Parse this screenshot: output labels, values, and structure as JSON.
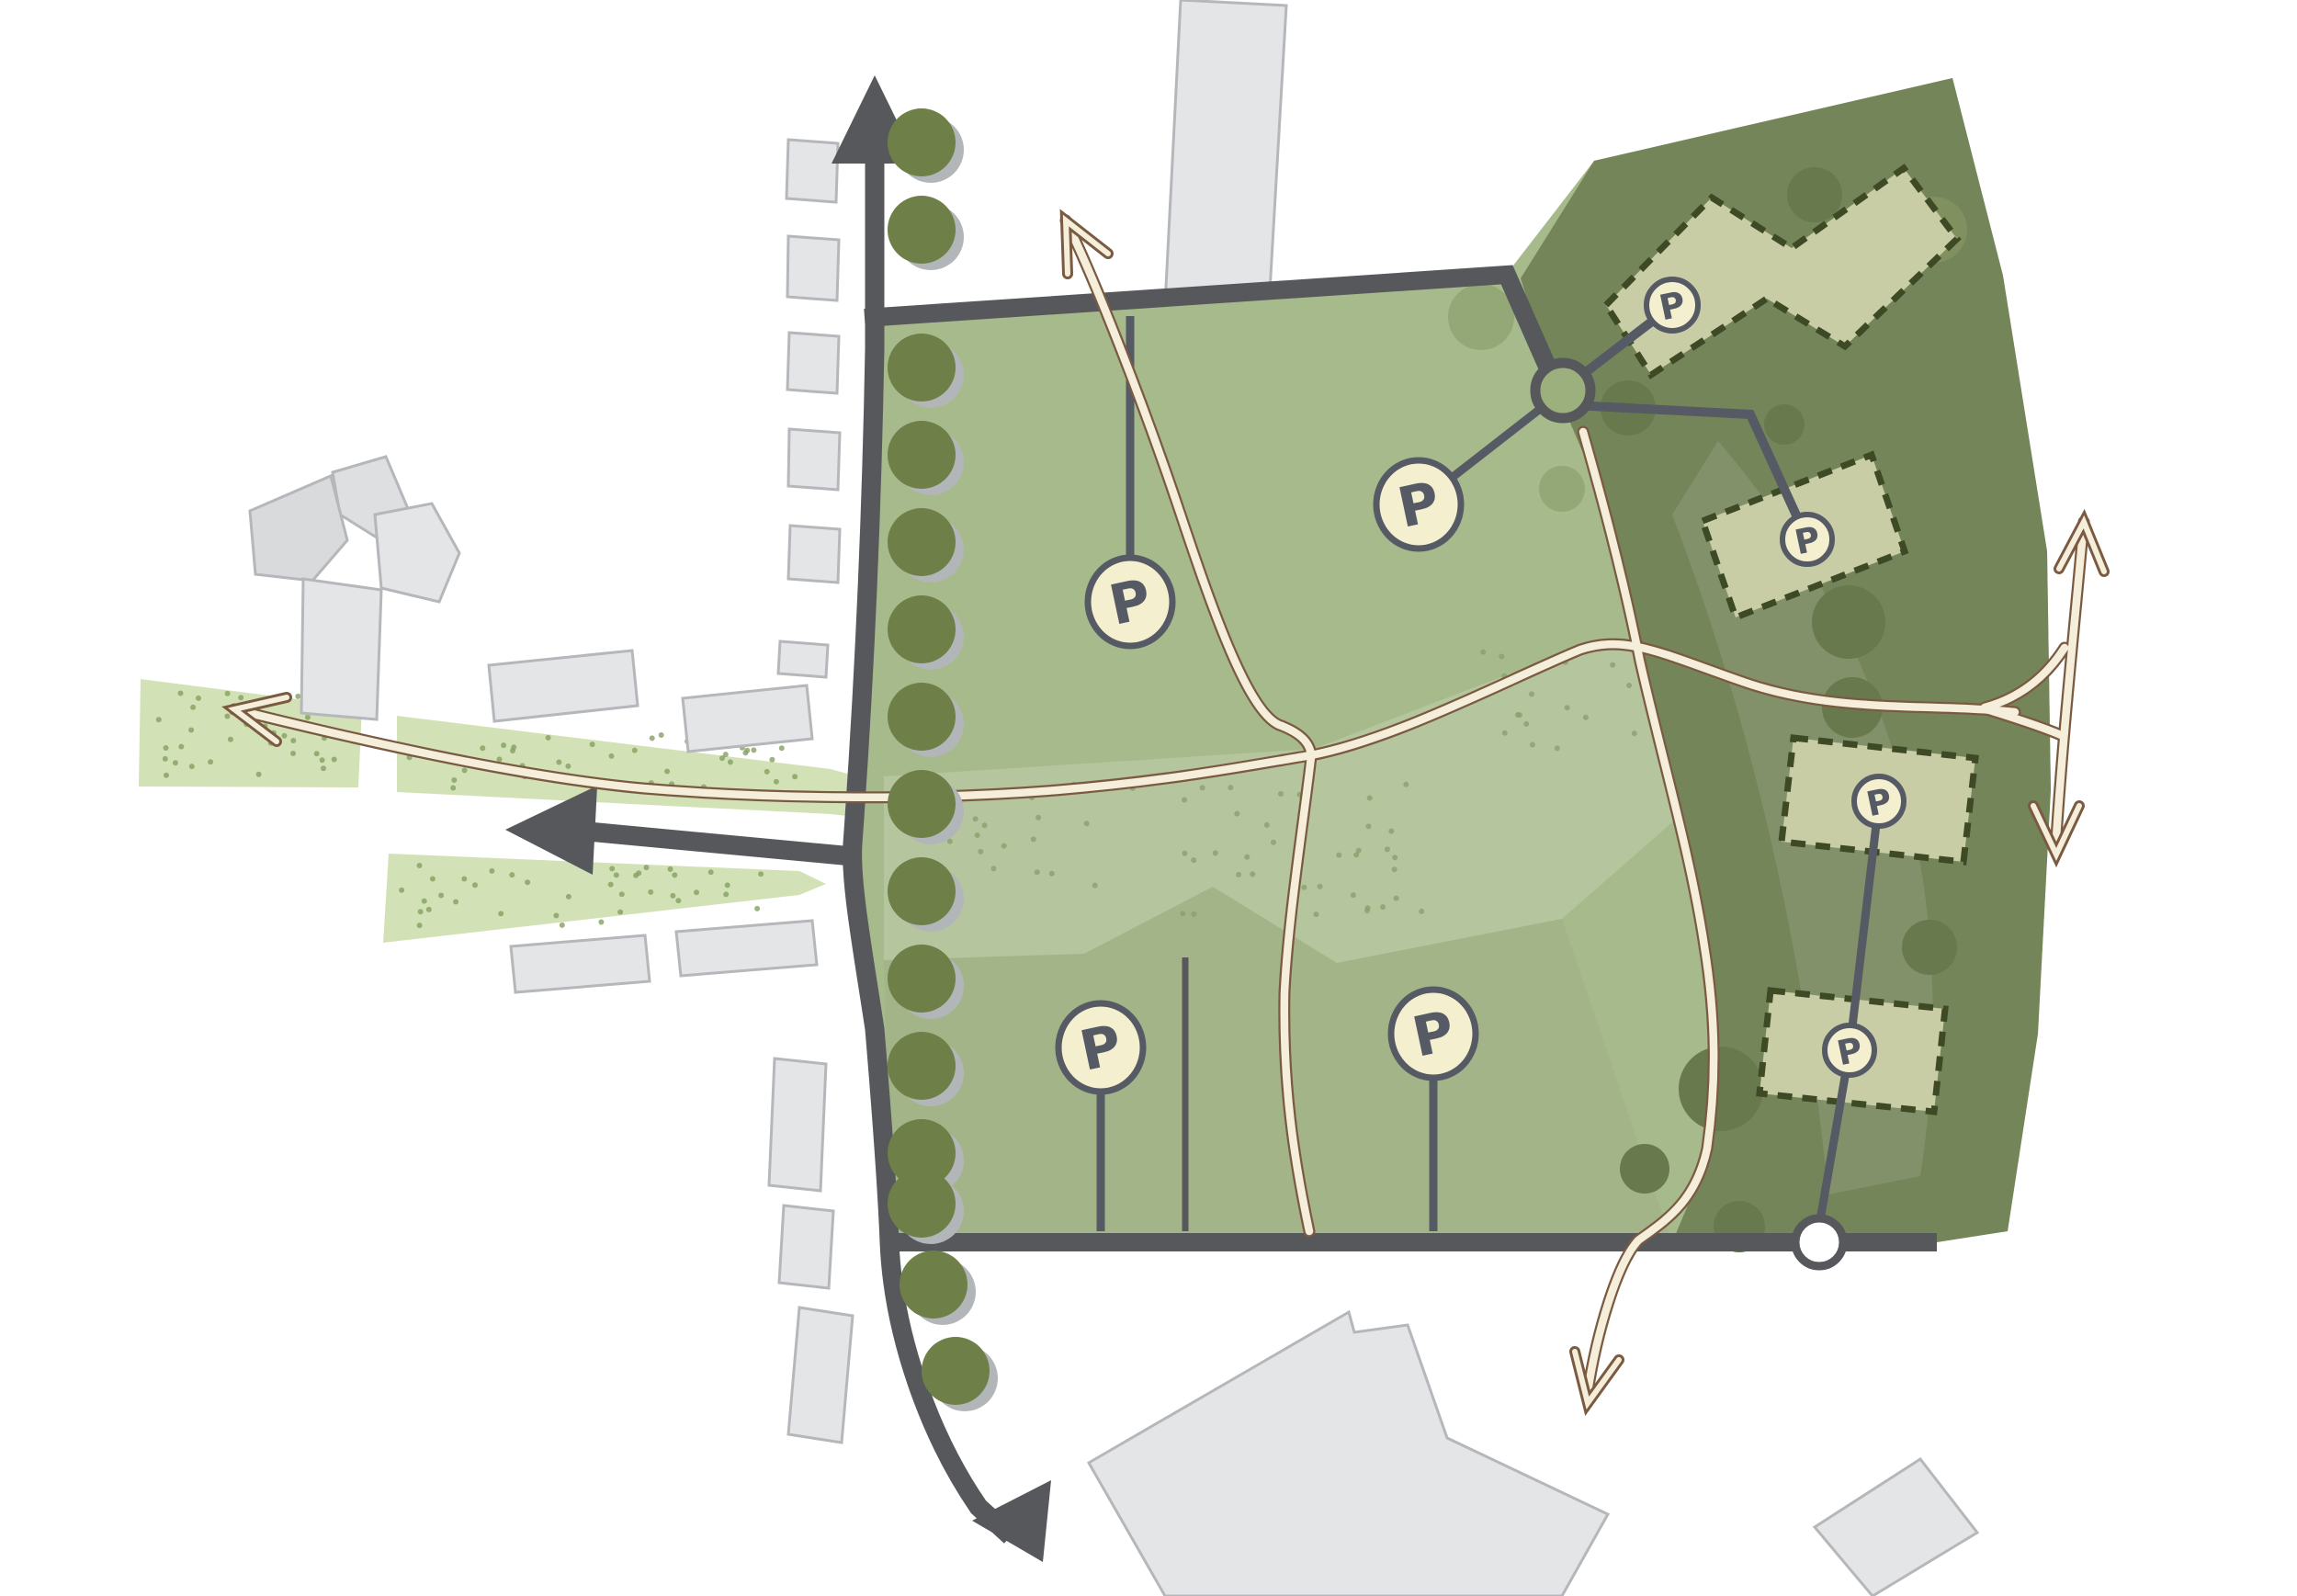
{
  "diagram": {
    "kind": "landscape-site-plan",
    "parking": {
      "large": [
        {
          "id": "field-northwest",
          "label": "P"
        },
        {
          "id": "field-north-center",
          "label": "P"
        },
        {
          "id": "field-southwest",
          "label": "P"
        },
        {
          "id": "field-south-center",
          "label": "P"
        }
      ],
      "small": [
        {
          "id": "woodland-building-north",
          "label": "P"
        },
        {
          "id": "woodland-building-east",
          "label": "P"
        },
        {
          "id": "woodland-building-center",
          "label": "P"
        },
        {
          "id": "woodland-building-south",
          "label": "P"
        }
      ]
    },
    "icons": [
      "road-arrow-up-icon",
      "road-arrow-left-icon",
      "road-arrow-down-icon",
      "path-arrow-northwest-icon",
      "path-arrow-north-icon",
      "path-arrow-south-icon",
      "path-arrow-double-vertical-icon",
      "roundabout-node-icon",
      "connection-node-icon"
    ],
    "counts": {
      "parking_badges": 8,
      "proposed_buildings": 4,
      "street_trees": 15
    },
    "colors": {
      "site_green": "#a7ba8c",
      "woodland_green": "#75855a",
      "verge_green": "#d3e2b6",
      "road_gray": "#56585c",
      "existing_building_gray": "#e4e5e7",
      "proposed_building_fill": "#c8cda5",
      "proposed_building_outline": "#3e4a26",
      "path_cream": "#f4eedb",
      "path_outline": "#7a5a41",
      "badge_cream": "#f4efcf",
      "badge_outline": "#565a64",
      "tree_olive": "#6f7f48"
    }
  }
}
